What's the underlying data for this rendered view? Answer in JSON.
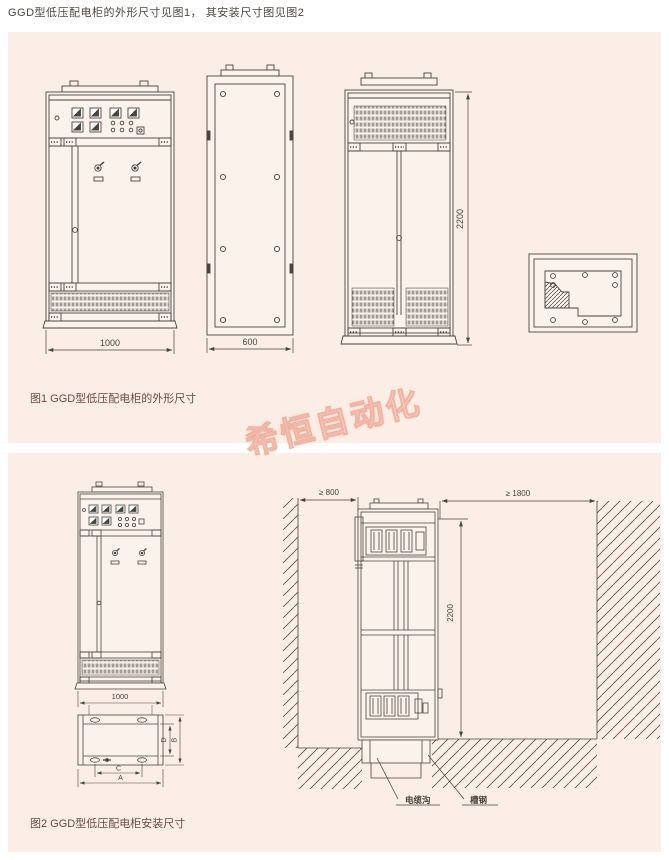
{
  "header": {
    "text": "GGD型低压配电柜的外形尺寸见图1， 其安装尺寸图见图2"
  },
  "watermark": {
    "text": "希恒自动化",
    "color": "#e8795f"
  },
  "colors": {
    "panel_bg": "#fbeee6",
    "drawing_line": "#4a443f",
    "caption_text": "#6b4b42",
    "page_bg": "#ffffff"
  },
  "figure1": {
    "caption": "图1 GGD型低压配电柜的外形尺寸",
    "dims": {
      "width": "1000",
      "depth": "600",
      "height": "2200"
    }
  },
  "figure2": {
    "caption": "图2 GGD型低压配电柜安装尺寸",
    "dims": {
      "width": "1000",
      "clear_left": "≥ 800",
      "clear_right": "≥ 1800",
      "height": "2200",
      "a": "A",
      "b": "B",
      "c": "C",
      "d": "D"
    },
    "labels": {
      "cable_trench": "电缆沟",
      "channel_steel": "槽钢"
    }
  }
}
